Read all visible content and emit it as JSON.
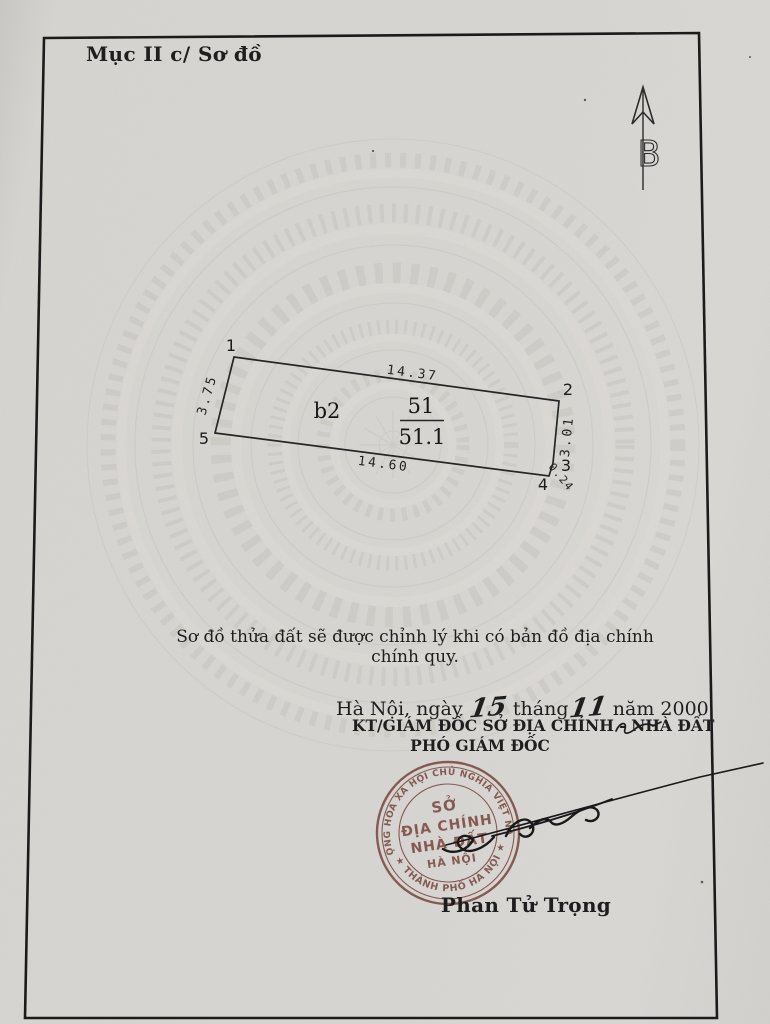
{
  "header": {
    "section_title": "Mục II c/ Sơ đồ"
  },
  "compass": {
    "north_letter": "B"
  },
  "parcel": {
    "vertex_labels": [
      "1",
      "2",
      "3",
      "4",
      "5"
    ],
    "edges": {
      "top": "14.37",
      "right": "3.01",
      "cut": "0.24",
      "bottom": "14.60",
      "left": "3.75"
    },
    "block_label": "b2",
    "number": "51",
    "area": "51.1"
  },
  "note": {
    "text": "Sơ đồ thửa đất sẽ được chỉnh lý khi có bản đồ địa chính chính quy."
  },
  "signing": {
    "place_prefix": "Hà Nội, ngày",
    "day": "15",
    "month_label": "tháng",
    "month": "11",
    "year_label": "năm",
    "year": "2000",
    "approver_title": "KT/GIÁM ĐỐC SỞ ĐỊA CHÍNH - NHÀ ĐẤT",
    "approver_role": "PHÓ GIÁM ĐỐC",
    "signer_name": "Phan Tử Trọng"
  },
  "stamp": {
    "top_arc": "CỘNG HOÀ XÃ HỘI CHỦ NGHĨA VIỆT NAM",
    "bottom_arc": "★ THÀNH PHỐ HÀ NỘI ★",
    "center_line1": "SỞ",
    "center_line2": "ĐỊA CHÍNH",
    "center_line3": "NHÀ ĐẤT",
    "center_line4": "HÀ NỘI"
  },
  "colors": {
    "paper": "#d5d2ce",
    "ink": "#1e1e1e",
    "stamp_ink": "#7a4a41"
  }
}
